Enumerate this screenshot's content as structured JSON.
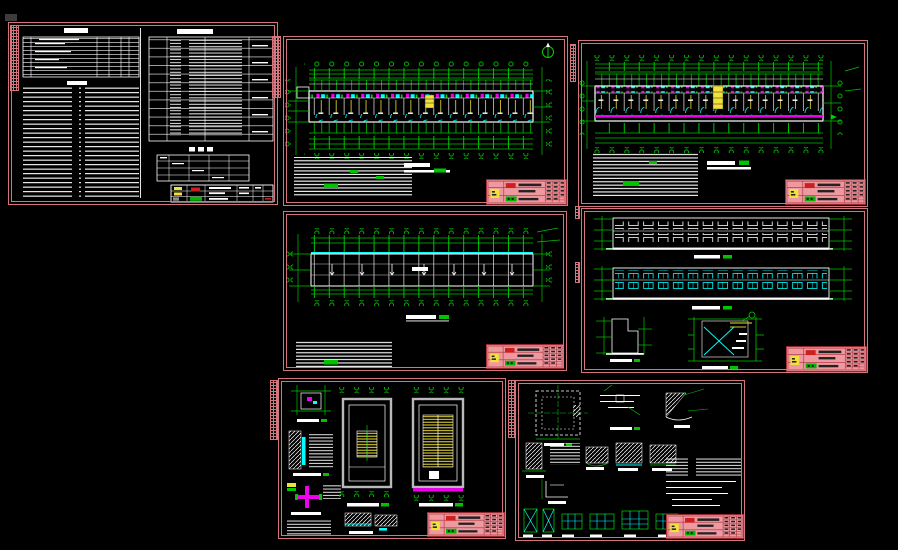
{
  "meta": {
    "description": "CAD drawing set: seven architectural sheets (dormitory building) on black model-space background",
    "canvas_bg": "#000000"
  },
  "palette": {
    "sheet_border_pink": "#d4747c",
    "titleblock_pink": "#ee98a0",
    "titleblock_line": "#a83038",
    "dim_green": "#00c400",
    "bright_green": "#00ff00",
    "cyan": "#00ffff",
    "magenta": "#ee00ee",
    "yellow": "#f2e13a",
    "red_patch": "#cc2020",
    "white": "#ffffff",
    "wall_gray": "#b9b9b9"
  },
  "sheets": [
    {
      "id": "sheet-1",
      "name": "general-notes-and-schedules"
    },
    {
      "id": "sheet-2",
      "name": "first-floor-plan"
    },
    {
      "id": "sheet-3",
      "name": "standard-floor-plan"
    },
    {
      "id": "sheet-4",
      "name": "roof-plan"
    },
    {
      "id": "sheet-5",
      "name": "elevations-and-stair-section"
    },
    {
      "id": "sheet-6",
      "name": "stair-plan-details"
    },
    {
      "id": "sheet-7",
      "name": "construction-details-and-window-types"
    }
  ]
}
